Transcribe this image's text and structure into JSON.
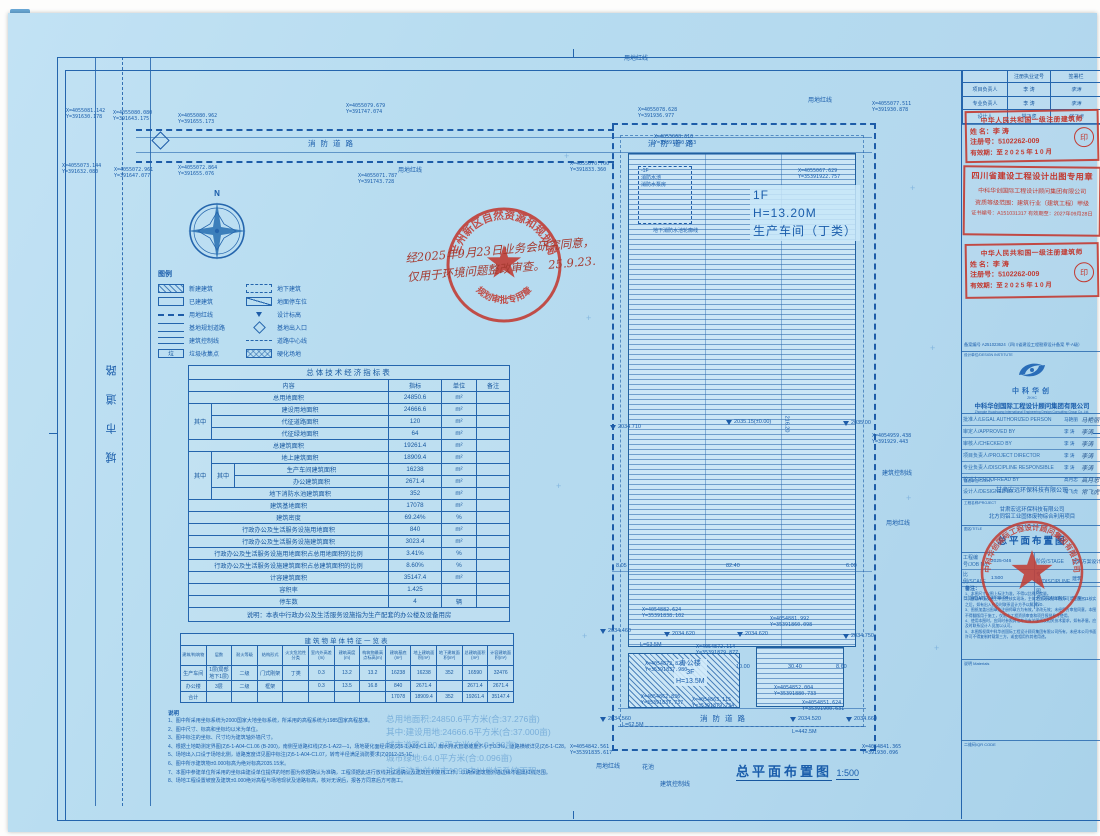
{
  "sheet": {
    "plan_title": "总平面布置图",
    "plan_scale": "1:500",
    "north_label": "N"
  },
  "roads": {
    "city_road": "城市道路",
    "fire_road": "消防道路"
  },
  "site_labels": {
    "red_line": "用地红线",
    "control_line": "建筑控制线",
    "flower_bed": "花池",
    "pool_outline": "地下消防水池轮廓线",
    "basement_floor": "-1F",
    "fire_pool": "消防水池",
    "pump_room": "消防水泵房"
  },
  "workshop": {
    "line1": "1F",
    "line2": "H=13.20M",
    "line3": "生产车间（丁类）"
  },
  "office": {
    "line1": "办公楼",
    "line2": "3F",
    "line3": "H=13.5M"
  },
  "elevations": [
    {
      "v": "2034.460"
    },
    {
      "v": "2034.620"
    },
    {
      "v": "2034.620"
    },
    {
      "v": "2034.750"
    },
    {
      "v": "2034.710"
    },
    {
      "v": "2035.15(±0.00)"
    },
    {
      "v": "2035.00"
    },
    {
      "v": "2034.560"
    },
    {
      "v": "2034.520"
    },
    {
      "v": "2034.660"
    }
  ],
  "dimensions": {
    "d0": "8.05",
    "d1": "82.40",
    "d2": "6.00",
    "d3": "216.20",
    "d4": "10.00",
    "d5": "30.40",
    "d6": "8.60",
    "len0": "L=63.5M",
    "len1": "L=62.5M",
    "len2": "L=442.5M"
  },
  "coords": [
    {
      "x": "X=4055081.142",
      "y": "Y=391630.178"
    },
    {
      "x": "X=4055080.080",
      "y": "Y=391643.175"
    },
    {
      "x": "X=4055080.962",
      "y": "Y=391655.173"
    },
    {
      "x": "X=4055073.144",
      "y": "Y=391632.080"
    },
    {
      "x": "X=4055072.961",
      "y": "Y=391647.077"
    },
    {
      "x": "X=4055072.864",
      "y": "Y=391655.076"
    },
    {
      "x": "X=4055071.787",
      "y": "Y=391743.728"
    },
    {
      "x": "X=4055079.679",
      "y": "Y=391747.074"
    },
    {
      "x": "X=4055078.628",
      "y": "Y=391936.977"
    },
    {
      "x": "X=4055077.511",
      "y": "Y=391930.878"
    },
    {
      "x": "X=4055068.610",
      "y": "Y=35391840.363"
    },
    {
      "x": "X=4055067.629",
      "y": "Y=35391922.757"
    },
    {
      "x": "X=4055070.700",
      "y": "Y=391833.360"
    },
    {
      "x": "X=4054959.438",
      "y": "Y=391929.443"
    },
    {
      "x": "X=4054882.624",
      "y": "Y=35391838.102"
    },
    {
      "x": "X=4054881.992",
      "y": "Y=35391860.098"
    },
    {
      "x": "X=4054872.114",
      "y": "Y=35391879.877"
    },
    {
      "x": "X=4054872.828",
      "y": "Y=35391837.980"
    },
    {
      "x": "X=4054862.836",
      "y": "Y=35391837.737"
    },
    {
      "x": "X=4054863.115",
      "y": "Y=35391879.734"
    },
    {
      "x": "X=4054852.004",
      "y": "Y=35391880.733"
    },
    {
      "x": "X=4054851.624",
      "y": "Y=35391900.631"
    },
    {
      "x": "X=4054842.561",
      "y": "Y=35391835.617"
    },
    {
      "x": "X=4054841.365",
      "y": "Y=391930.096"
    }
  ],
  "legend": {
    "title": "图例",
    "items": [
      {
        "label": "新建建筑"
      },
      {
        "label": "地下建筑"
      },
      {
        "label": "已建建筑"
      },
      {
        "label": "地面停车位"
      },
      {
        "label": "用地红线"
      },
      {
        "label": "设计标高"
      },
      {
        "label": "基地规划道路"
      },
      {
        "label": "基地出入口"
      },
      {
        "label": "建筑控制线"
      },
      {
        "label": "道路中心线"
      },
      {
        "label": "垃圾收集点",
        "glyph": "垃"
      },
      {
        "label": "硬化场地"
      }
    ]
  },
  "indicators": {
    "title": "总体技术经济指标表",
    "col_content": "内容",
    "col_value": "指标",
    "col_unit": "单位",
    "col_note": "备注",
    "sub_label": "其中",
    "r_total_land": {
      "label": "总用地面积",
      "v": "24850.6",
      "u": "m²"
    },
    "r_constr_land": {
      "label": "建设用地面积",
      "v": "24666.6",
      "u": "m²"
    },
    "r_road": {
      "label": "代征道路面积",
      "v": "120",
      "u": "m²"
    },
    "r_green": {
      "label": "代征绿地面积",
      "v": "64",
      "u": "m²"
    },
    "r_total_build": {
      "label": "总建筑面积",
      "v": "19261.4",
      "u": "m²"
    },
    "r_above": {
      "label": "地上建筑面积",
      "v": "18909.4",
      "u": "m²"
    },
    "r_workshop": {
      "label": "生产车间建筑面积",
      "v": "16238",
      "u": "m²"
    },
    "r_office": {
      "label": "办公建筑面积",
      "v": "2671.4",
      "u": "m²"
    },
    "r_pool": {
      "label": "地下消防水池建筑面积",
      "v": "352",
      "u": "m²"
    },
    "r_base": {
      "label": "建筑基地面积",
      "v": "17078",
      "u": "m²"
    },
    "r_density": {
      "label": "建筑密度",
      "v": "69.24%",
      "u": "%"
    },
    "r_admin_land": {
      "label": "行政办公及生活服务设施用地面积",
      "v": "840",
      "u": "m²"
    },
    "r_admin_build": {
      "label": "行政办公及生活服务设施建筑面积",
      "v": "3023.4",
      "u": "m²"
    },
    "r_admin_land_ratio": {
      "label": "行政办公及生活服务设施用地面积占总用地面积的比例",
      "v": "3.41%",
      "u": "%"
    },
    "r_admin_build_ratio": {
      "label": "行政办公及生活服务设施建筑面积占总建筑面积的比例",
      "v": "8.60%",
      "u": "%"
    },
    "r_fa": {
      "label": "计容建筑面积",
      "v": "35147.4",
      "u": "m²"
    },
    "r_far": {
      "label": "容积率",
      "v": "1.425",
      "u": ""
    },
    "r_parking": {
      "label": "停车数",
      "v": "4",
      "u": "辆"
    },
    "footnote": "说明：本表中行政办公及生活服务设施指为生产配套的办公楼及设备用房"
  },
  "buildings": {
    "title": "建筑物单体特征一览表",
    "headers": [
      "建筑/构筑物",
      "层数",
      "耐火等级",
      "结构形式",
      "火灾危险性分类",
      "室内外高差(m)",
      "建筑高度(m)",
      "构筑物最高点标高(m)",
      "建筑基底(m²)",
      "地上建筑面积(m²)",
      "地下建筑面积(m²)",
      "总建筑面积(m²)",
      "计容建筑面积(m²)"
    ],
    "rows": [
      [
        "生产车间",
        "1层(局部地下1层)",
        "二级",
        "门式刚架",
        "丁类",
        "0.3",
        "13.2",
        "13.2",
        "16238",
        "16238",
        "352",
        "16590",
        "32476"
      ],
      [
        "办公楼",
        "3层",
        "二级",
        "框架",
        "",
        "0.3",
        "13.5",
        "16.8",
        "840",
        "2671.4",
        "",
        "2671.4",
        "2671.4"
      ],
      [
        "合计",
        "",
        "",
        "",
        "",
        "",
        "",
        "",
        "17078",
        "18909.4",
        "352",
        "19261.4",
        "35147.4"
      ]
    ]
  },
  "plan_notes": {
    "title": "说明",
    "lines": [
      "1、图中所采用坐标系统为2000国家大地坐标系统，所采用的高程系统为1985国家高程基准。",
      "2、图中尺寸、标高和坐标均以米为单位。",
      "3、图中标注的坐标、尺寸均为建筑轴外墙尺寸。",
      "4、根据土地勘测定界图(2)5-1-A04-C1.06 (B-200)，南侧至道路红线(2)5-1-A22—1，场地硬化面经评定(2)5-1-A03-C1.01，雨水排水管道坡度不小于0.3%，道路横坡详见(2)5-1-C28。",
      "5、场地出入口设于场地北侧，道路宽度详见图中标注(2)5-1-A04-C1.07，转弯半径满足消防要求(2)2012-15-1C。",
      "6、图中所示建筑物±0.000标高为绝对标高2035.15米。",
      "7、本图中参建单位所采用的坐标由建设单位提供的地形图为依据确认为准确，工程须据此进行放线并试验确认及建筑控制复核工作，以确保建筑物外墙边缘不超出红线范围。",
      "8、场地工程设置坡度及建筑±0.000绝对高程与场地现状及道路标高，核对无误后，报各方同意后方可施工。"
    ]
  },
  "area_summary": {
    "lines": [
      "总用地面积:24850.6平方米(合:37.276亩)",
      "其中:建设用地:24666.6平方米(合:37.000亩)",
      "城市道路:120.0平方米(合:0.180亩)",
      "城市绿地:64.0平方米(合:0.096亩)",
      "注:标注为兰州市1995中川坐标系统面积"
    ]
  },
  "planning_stamp": {
    "ring_text": "兰州新区自然资源和规划局",
    "banner_text": "规划审批专用章",
    "hand_line1": "经2025年9月23日业务会研究同意，",
    "hand_line2": "仅用于环境问题整改审查。",
    "hand_date": "25.9.23."
  },
  "title_block": {
    "top_table": {
      "h1": "注册执业证号",
      "h2": "签署栏",
      "rows": [
        {
          "role": "项目负责人",
          "name": "李 涛",
          "sig": "李涛"
        },
        {
          "role": "专业负责人",
          "name": "李 涛",
          "sig": "李涛"
        },
        {
          "role": "设计人",
          "name": "常飞虎",
          "sig": "常飞虎"
        }
      ]
    },
    "architect_stamp": {
      "title": "中华人民共和国一级注册建筑师",
      "name_label": "姓 名：",
      "name": "李  涛",
      "reg_label": "注册号：",
      "reg": "5102262-009",
      "valid_label": "有效期：",
      "valid": "至 2 0 2 5 年 1 0 月",
      "seal_glyph": "印"
    },
    "sichuan_seal": {
      "line1": "四川省建设工程设计出图专用章",
      "line2": "中科华创国际工程设计顾问集团有限公司",
      "line3": "资质等级范围：建筑行业（建筑工程）甲级",
      "line4": "证书编号：A151031317  有效期至：2027年09月28日"
    },
    "record_no": "备案编号 A251023624（四川省建设工程勘察设计备案 甲·A级）",
    "design_institute_label": "设计单位/DESIGN INSTITUTE",
    "logo_text": "中科华创",
    "logo_sub": "ZKHC",
    "company_cn": "中科华创国际工程设计顾问集团有限公司",
    "company_en": "Zhongke Huachuang International Engineering Design Consulting Group Co.,Ltd.",
    "sign_rows": [
      {
        "role": "批准人/LEGAL AUTHORIZED PERSON",
        "name": "马艳丽",
        "sig": "马艳丽"
      },
      {
        "role": "审定人/APPROVED BY",
        "name": "李 涛",
        "sig": "李涛"
      },
      {
        "role": "审核人/CHECKED BY",
        "name": "李 涛",
        "sig": "李涛"
      },
      {
        "role": "项目负责人/PROJECT DIRECTOR",
        "name": "李 涛",
        "sig": "李涛"
      },
      {
        "role": "专业负责人/DISCIPLINE RESPONSIBLE",
        "name": "李 涛",
        "sig": "李涛"
      },
      {
        "role": "校对人/PROOFREAD BY",
        "name": "高月忠",
        "sig": "高月忠"
      },
      {
        "role": "设计人/DESIGNED BY",
        "name": "常飞虎",
        "sig": "常飞虎"
      }
    ],
    "client_label": "建设单位/CLIENT",
    "client": "甘肃宏远环保科技有限公司",
    "project_label": "工程名称/PROJECT",
    "project_line1": "甘肃宏远环保科技有限公司",
    "project_line2": "北方同铝工业固体废物综合利用项目",
    "company_seal_ring": "中科华创国际工程设计顾问集团有限公司",
    "drawing_title_label": "图名/TITLE",
    "drawing_title": "总平面布置图",
    "grid": {
      "job_label": "工程编号/JOB No.",
      "job": "2025-046",
      "stage_label": "阶段/STAGE",
      "stage": "建筑方案设计",
      "scale_label": "比例/SCALE",
      "scale": "1:500",
      "major_label": "专业/DISCIPLINE",
      "major": "建筑",
      "date_label": "日期/DATE",
      "date": "2025.09",
      "dwg_label": "图号/DRAWING No.",
      "dwg": "建施-01"
    },
    "remark_title": "备注：",
    "remarks": [
      "1、本图尺寸以图上标注为准，不得以比例尺度量。",
      "2、建设单位及施工单位应核实现场，主体定位无误后本图方可用于施工，核实之后，如有出入应及时联系设计方予以解决。",
      "3、图纸加盖出图章及注册师章方为有效，涂改无效；未经甲方审批同意，本图不得翻版用于施工，仅限本工程资质审查和项目报批参考使用。",
      "4、使用本图时，应同时参照其他专业有关图纸及相关技术要求，如有矛盾，应及时联系设计人员加以认可。",
      "5、本图版权属中科华创国际工程设计顾问集团有限公司所有，未经本公司书面许可不得复制转载第三方，或变相用作其他用途。"
    ],
    "materials_label": "说明 Materials",
    "qr_label": "二维码/QR CODE"
  }
}
